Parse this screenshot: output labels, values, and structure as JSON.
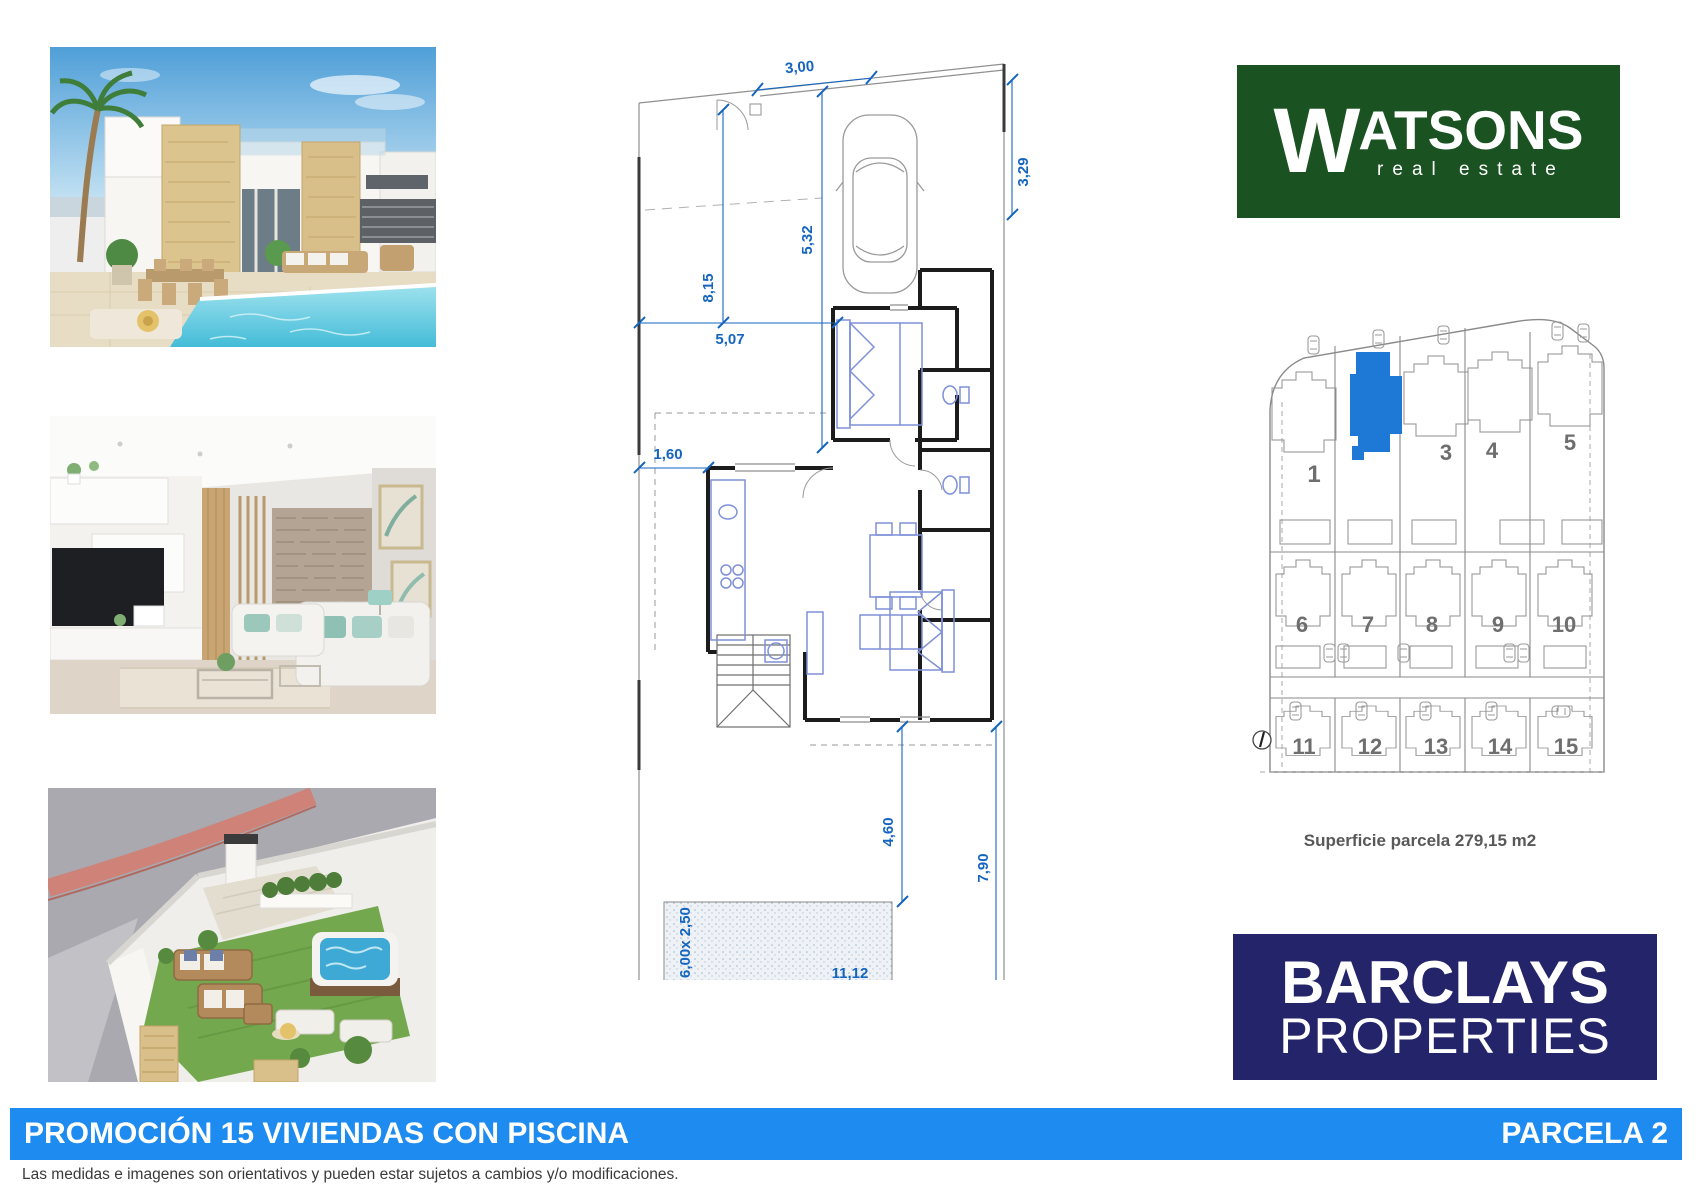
{
  "header": {
    "watsons": {
      "initial": "W",
      "name_rest": "ATSONS",
      "tagline": "real estate"
    },
    "barclays": {
      "line1": "BARCLAYS",
      "line2": "PROPERTIES"
    }
  },
  "floorplan": {
    "dims": {
      "top_width": "3,00",
      "right_depth": "3,29",
      "garage_length": "5,32",
      "left_depth": "8,15",
      "mid_width": "5,07",
      "side_offset": "1,60",
      "terrace_depth": "4,60",
      "garden_depth": "7,90",
      "garden_width": "11,12",
      "pool_size": "6,00x 2,50"
    }
  },
  "siteplan": {
    "row1": [
      "1",
      "3",
      "4",
      "5"
    ],
    "row2": [
      "6",
      "7",
      "8",
      "9",
      "10"
    ],
    "row3": [
      "11",
      "12",
      "13",
      "14",
      "15"
    ],
    "caption": "Superficie parcela 279,15 m2"
  },
  "footer": {
    "promo": "PROMOCIÓN 15 VIVIENDAS CON PISCINA",
    "parcela": "PARCELA 2",
    "disclaimer": "Las medidas e imagenes son orientativos y pueden estar sujetos a cambios y/o modificaciones."
  },
  "colors": {
    "accent_blue": "#1E8BF0",
    "dimension_blue": "#1565C0",
    "parcel_highlight": "#1E78D6",
    "watsons_green": "#1A5321",
    "barclays_navy": "#24246A"
  }
}
